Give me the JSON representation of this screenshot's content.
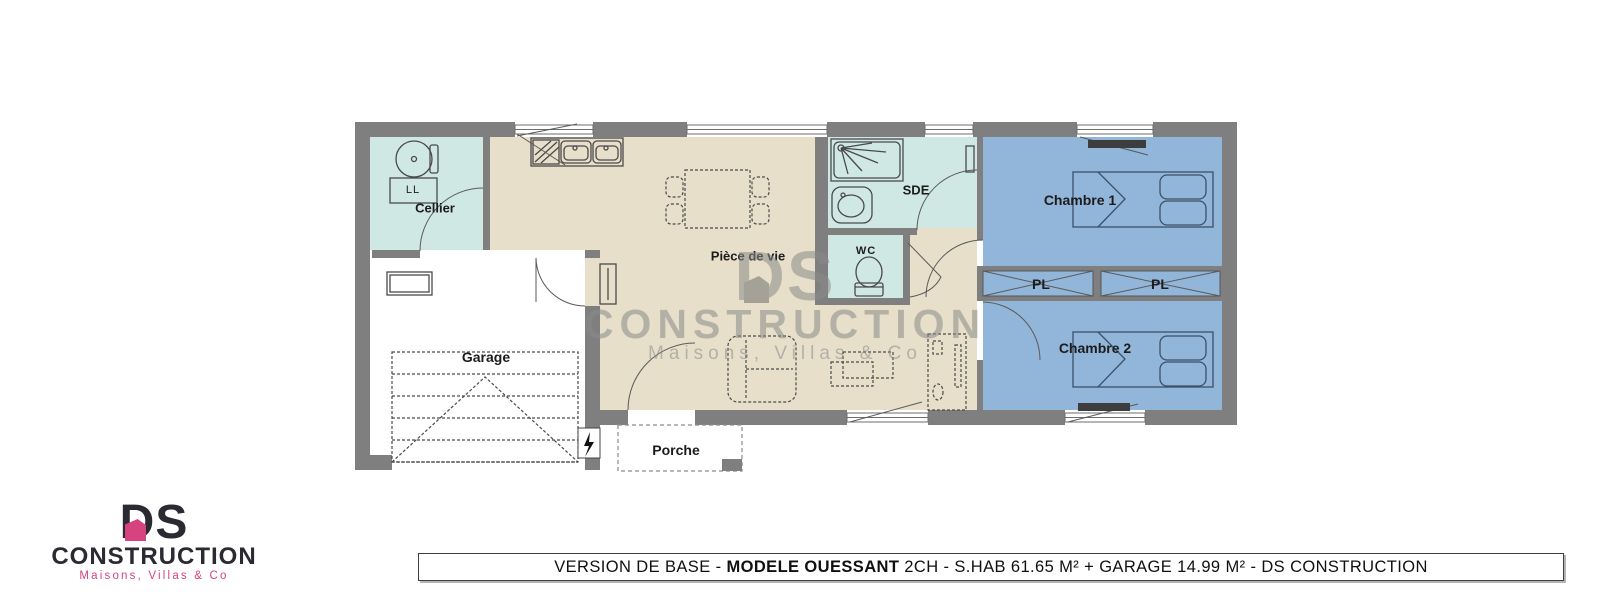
{
  "colors": {
    "wall": "#7f7f7f",
    "service_room": "#cfe8e4",
    "living_room": "#e7dfca",
    "bedroom": "#92b6d9",
    "furniture_line": "#4a4a4a",
    "bed_line": "#3c5068",
    "logo_dark": "#2b2a33",
    "logo_pink": "#d6437f",
    "watermark_gray": "#8a8a8a"
  },
  "floorplan": {
    "rooms": {
      "cellier": "Cellier",
      "piece_de_vie": "Pièce de vie",
      "sde": "SDE",
      "wc": "WC",
      "chambre1": "Chambre 1",
      "chambre2": "Chambre 2",
      "garage": "Garage",
      "porche": "Porche"
    },
    "closets": {
      "pl": "PL"
    },
    "appliances": {
      "washer": "LL"
    }
  },
  "watermark": {
    "brand": "DS",
    "name": "CONSTRUCTION",
    "tagline": "Maisons, Villas & Co"
  },
  "logo": {
    "brand": "DS",
    "name": "CONSTRUCTION",
    "tagline": "Maisons, Villas & Co"
  },
  "footer": {
    "prefix": "VERSION DE BASE - ",
    "model": "MODELE OUESSANT",
    "suffix": " 2CH - S.HAB 61.65 M² + GARAGE 14.99 M² - DS CONSTRUCTION"
  }
}
